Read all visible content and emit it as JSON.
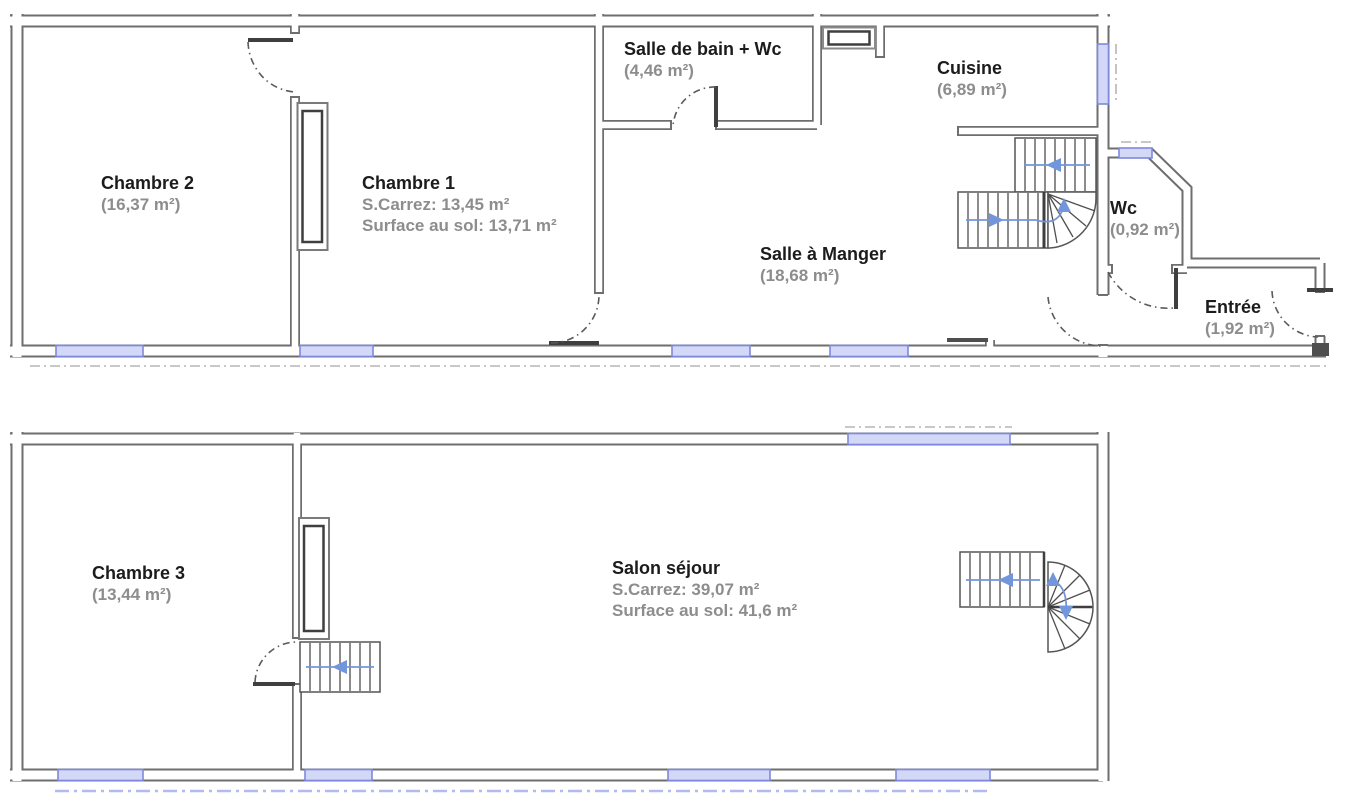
{
  "plan": {
    "type": "floor-plan",
    "floors": [
      {
        "rooms": [
          {
            "id": "chambre-2",
            "label": "Chambre 2",
            "line2": "(16,37 m²)"
          },
          {
            "id": "chambre-1",
            "label": "Chambre 1",
            "line2": "S.Carrez: 13,45 m²",
            "line3": "Surface au sol: 13,71 m²"
          },
          {
            "id": "salle-de-bain-wc",
            "label": "Salle de bain + Wc",
            "line2": "(4,46 m²)"
          },
          {
            "id": "cuisine",
            "label": "Cuisine",
            "line2": "(6,89 m²)"
          },
          {
            "id": "salle-a-manger",
            "label": "Salle à Manger",
            "line2": "(18,68 m²)"
          },
          {
            "id": "wc",
            "label": "Wc",
            "line2": "(0,92 m²)"
          },
          {
            "id": "entree",
            "label": "Entrée",
            "line2": "(1,92 m²)"
          }
        ]
      },
      {
        "rooms": [
          {
            "id": "chambre-3",
            "label": "Chambre 3",
            "line2": "(13,44 m²)"
          },
          {
            "id": "salon-sejour",
            "label": "Salon séjour",
            "line2": "S.Carrez: 39,07 m²",
            "line3": "Surface au sol: 41,6 m²"
          }
        ]
      }
    ],
    "colors": {
      "wall": "#6e6e6e",
      "wall_fill": "#ffffff",
      "window_line": "#7e88de",
      "window_fill": "#d3d8f7",
      "stair_arrow": "#7296dc",
      "door_arc": "#5a5a5a",
      "room_name": "#1c1c1c",
      "room_area": "#8d8d8d",
      "exterior_dash": "#b5b5b5",
      "exterior_dash_blue": "#b3baef"
    }
  }
}
